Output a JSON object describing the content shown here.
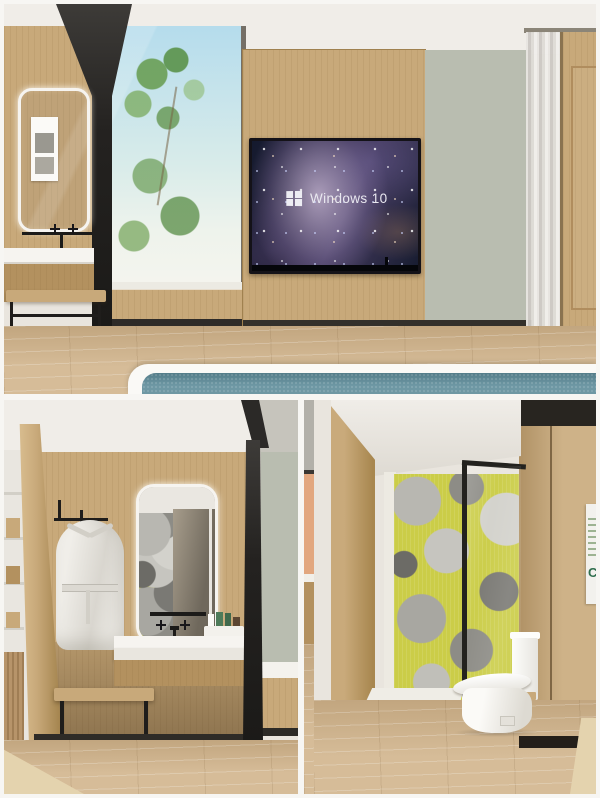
{
  "title": "Hotel guest room and bathroom interior render collage",
  "colors": {
    "frame_white": "#f7f6f3",
    "ceiling": "#f0ede8",
    "wood": "#c8a97a",
    "wood_dark": "#b3915f",
    "floor": "#d2b68f",
    "floor_light": "#e4d3ae",
    "sage": "#b9bdb0",
    "beam_black": "#2b2927",
    "teal": "#66929f",
    "sky": "#b5dcec",
    "tree": "#6fa45c",
    "yellow": "#cbcd48",
    "white_surface": "#f6f4f0",
    "nebula_dark": "#141a2e",
    "nebula_purple": "#463c60",
    "peach": "#e2a77f"
  },
  "panels": {
    "bedroom": {
      "name": "bedroom with wall TV, window and vanity",
      "tv": {
        "label": "Windows 10"
      }
    },
    "vanity_bathroom": {
      "name": "bathroom vanity nook with bathrobe and lit mirror"
    },
    "toilet_room": {
      "name": "toilet room with yellow floral feature wall",
      "sign": {
        "logo_letter": "C"
      }
    }
  }
}
